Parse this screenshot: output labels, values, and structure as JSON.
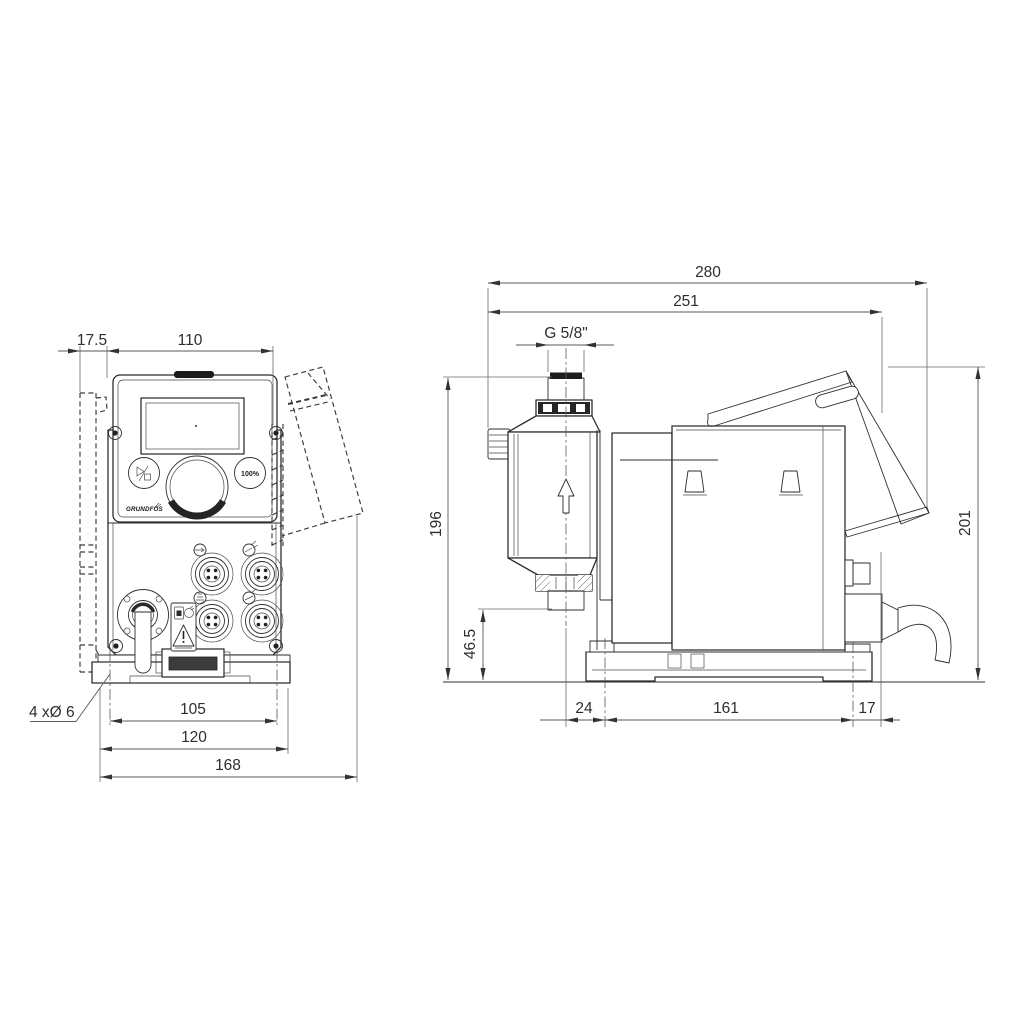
{
  "title": "Dosing pump dimensional drawing",
  "front_view": {
    "dims": {
      "offset": "17.5",
      "width": "110",
      "hole_spacing": "105",
      "base_width": "120",
      "total_width": "168"
    },
    "hole_note": "4 xØ 6",
    "panel": {
      "boost_label": "100%",
      "logo": "GRUNDFOS"
    }
  },
  "side_view": {
    "dims": {
      "total_depth": "280",
      "depth": "251",
      "thread": "G 5/8\"",
      "height": "196",
      "valve_height": "46.5",
      "rear_height": "201",
      "front_offset": "24",
      "hole_spacing": "161",
      "rear_offset": "17"
    }
  }
}
